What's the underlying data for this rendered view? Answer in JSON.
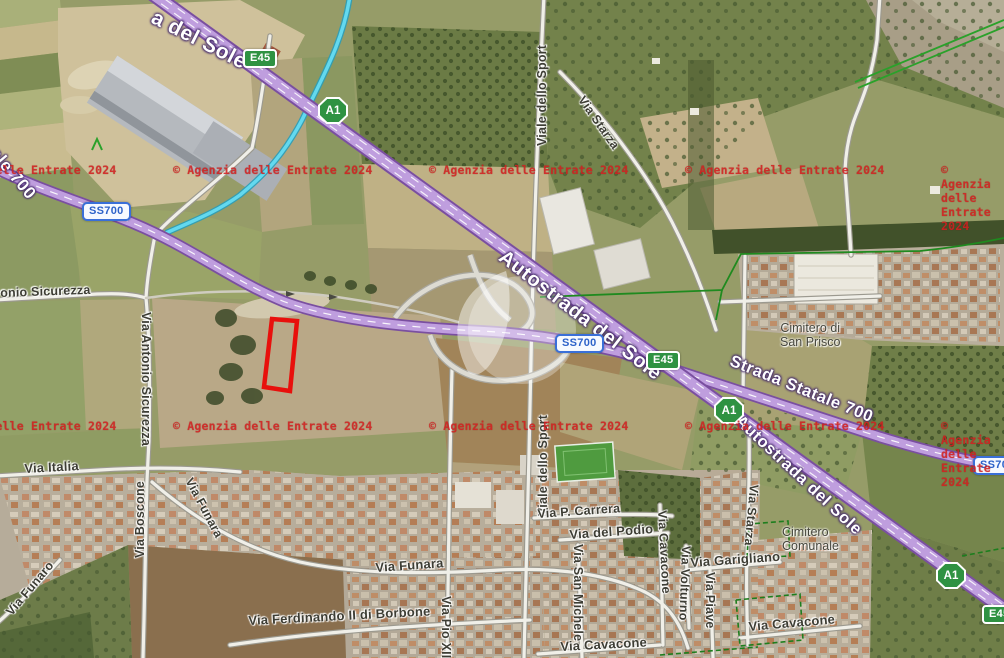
{
  "map": {
    "watermark": {
      "text": "© Agenzia delle Entrate 2024",
      "color": "#d22020"
    },
    "parcel": {
      "outline_color": "#e8100c"
    },
    "route_badges": {
      "a1": "A1",
      "e45": "E45",
      "ss700": "SS700"
    },
    "road_labels": {
      "autostrada_top": "a del Sole",
      "statale_topleft": "tale 700",
      "autostrada_mid": "Autostrada del Sole",
      "strada_statale_700": "Strada Statale 700",
      "autostrada_right": "Autostrada del Sole"
    },
    "street_labels": {
      "antonio_sicurezza_h": "onio Sicurezza",
      "antonio_sicurezza_v": "Via Antonio Sicurezza",
      "viale_dello_sport_top": "Viale dello Sport",
      "via_starza_top": "Via Starza",
      "viale_dello_sport_bottom": "Viale dello Sport",
      "via_p_carrera": "Via P. Carrera",
      "via_del_podio": "Via del Podio",
      "via_san_michele": "Via San Michele",
      "via_cavacone_v": "Via Cavacone",
      "via_volturno": "Via Volturno",
      "via_garigliano": "Via Garigliano",
      "via_piave": "Via Piave",
      "via_starza_south": "Via Starza",
      "via_cavacone_h_east": "Via Cavacone",
      "via_cavacone_h_center": "Via Cavacone",
      "via_italia": "Via Italia",
      "via_boscone": "Via Boscone",
      "via_funara_diag": "Via Funara",
      "via_funaro_sw": "Via Funaro",
      "via_funara_h": "Via Funara",
      "via_ferdinando": "Via Ferdinando II di Borbone",
      "via_pio_xii": "Via Pio XII"
    },
    "places": {
      "cimitero_sp_1": "Cimitero di",
      "cimitero_sp_2": "San Prisco",
      "cimitero_com_1": "Cimitero",
      "cimitero_com_2": "Comunale"
    },
    "map_colors": {
      "motorway": "#bf9ede",
      "motorway_casing": "#7a4fa0",
      "water": "#63d9ef",
      "boundary_green": "#229a22",
      "badge_green": "#2f9242",
      "badge_blue": "#2d62c9"
    }
  }
}
